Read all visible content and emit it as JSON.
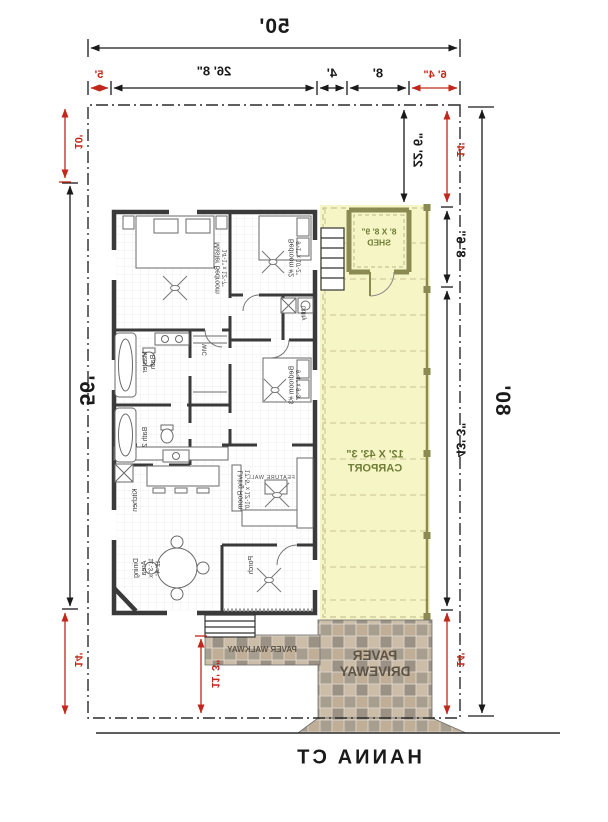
{
  "street": {
    "label": "HANNA CT"
  },
  "site": {
    "width_total": "50'",
    "depth_total": "80'",
    "depth_mid": "56'",
    "top": {
      "side_red": "6' 4\"",
      "shed_w": "8'",
      "gap": "4'",
      "house_w": "26' 8\"",
      "other_side_red": "5'"
    },
    "left": {
      "setback_top": "14'",
      "shed_offset": "22' 6\"",
      "shed_depth": "8' 6\"",
      "carport_len": "43' 3\"",
      "setback_bottom": "14'"
    },
    "right": {
      "setback_top": "10'",
      "setback_bottom": "14'"
    },
    "walkway_len": "11' 3\""
  },
  "carport": {
    "size": "12' X 43' 3\"",
    "name": "CARPORT"
  },
  "shed": {
    "size": "8' X 8' 9\"",
    "name": "SHED"
  },
  "paving": {
    "walkway": "PAVER WALKWAY",
    "driveway_line1": "PAVER",
    "driveway_line2": "DRIVEWAY"
  },
  "rooms": {
    "master_bedroom": {
      "name": "Master Bedroom",
      "size": "14'-1\" x 12'-7\""
    },
    "bedroom2": {
      "name": "Bedroom #2",
      "size": "9'-1\" x 10'-2\""
    },
    "bedroom3": {
      "name": "Bedroom #3",
      "size": "9'-4\" x 9'-3\""
    },
    "master_bath": {
      "name": "Master Bath"
    },
    "bath2": {
      "name": "Bath 2"
    },
    "wic": {
      "name": "WIC"
    },
    "utility": {
      "name": "Utility"
    },
    "kitchen": {
      "name": "Kitchen"
    },
    "dining": {
      "name": "Dining Area",
      "size": "11'-3\" x 12'-4\""
    },
    "living": {
      "name": "Living Room",
      "size": "17'-5\" x 12'-10\""
    },
    "porch": {
      "name": "Porch"
    },
    "feature_wall": "FEATURE WALL"
  },
  "colors": {
    "dimension_red": "#c1271b",
    "label_green": "#6f7d36",
    "carport_fill": "#f6f5c5",
    "shed_wall": "#8a8a52",
    "wall_dark": "#3a3a3a",
    "paver_tan": "#c0ae97"
  }
}
